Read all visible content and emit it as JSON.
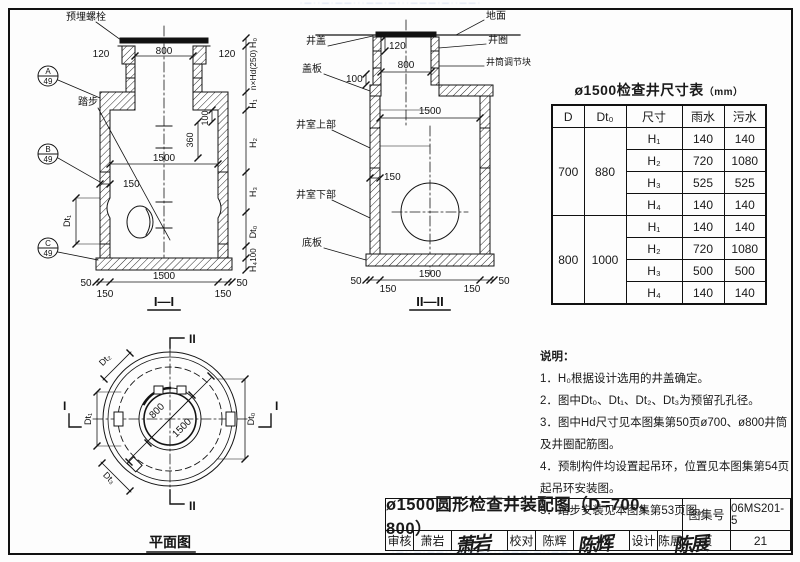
{
  "page": {
    "paper": "#fdfdfd",
    "line": "#1a1a1a",
    "watermark_color": "#7b97cf",
    "watermark_text": "·—··—·——···——·—···———·—··——·"
  },
  "s1": {
    "caption": "I—I",
    "bolt_label": "预埋螺栓",
    "step_label": "踏步",
    "d120": "120",
    "d800": "800",
    "d360": "360",
    "d100": "100",
    "d150": "150",
    "d1500": "1500",
    "d50": "50",
    "h0": "H₀",
    "nhd": "n×Hd(250)",
    "h1": "H₁",
    "h2": "H₂",
    "h3": "H₃",
    "h4": "H₄",
    "dt0": "Dt₀",
    "dt1": "Dt₁",
    "ca": "A",
    "cb": "B",
    "cc": "C",
    "cnum": "49"
  },
  "s2": {
    "caption": "II—II",
    "ground": "地面",
    "cover": "井盖",
    "ring": "井圈",
    "adjuster": "井筒调节块",
    "slab": "盖板",
    "upper": "井室上部",
    "lower": "井室下部",
    "base": "底板",
    "d120": "120",
    "d800": "800",
    "d100": "100",
    "d1500": "1500",
    "d150": "150",
    "d50": "50"
  },
  "plan": {
    "caption": "平面图",
    "d800": "800",
    "d1500": "1500",
    "dt0": "Dt₀",
    "dt1": "Dt₁",
    "dt2": "Dt₂",
    "dt3": "Dt₃",
    "mark_i": "I",
    "mark_ii": "II"
  },
  "table": {
    "title": "ø1500检查井尺寸表",
    "unit": "（mm）",
    "h_d": "D",
    "h_dto": "Dt₀",
    "h_size": "尺寸",
    "h_rain": "雨水",
    "h_sewage": "污水",
    "g1": {
      "d": "700",
      "dto": "880",
      "rows": [
        [
          "H₁",
          "140",
          "140"
        ],
        [
          "H₂",
          "720",
          "1080"
        ],
        [
          "H₃",
          "525",
          "525"
        ],
        [
          "H₄",
          "140",
          "140"
        ]
      ]
    },
    "g2": {
      "d": "800",
      "dto": "1000",
      "rows": [
        [
          "H₁",
          "140",
          "140"
        ],
        [
          "H₂",
          "720",
          "1080"
        ],
        [
          "H₃",
          "500",
          "500"
        ],
        [
          "H₄",
          "140",
          "140"
        ]
      ]
    }
  },
  "notes": {
    "title": "说明：",
    "n1": "1．H₀根据设计选用的井盖确定。",
    "n2": "2．图中Dt₀、Dt₁、Dt₂、Dt₃为预留孔孔径。",
    "n3": "3．图中Hd尺寸见本图集第50页ø700、ø800井筒及井圈配筋图。",
    "n4": "4．预制构件均设置起吊环，位置见本图集第54页起吊环安装图。",
    "n5": "5．踏步安装见本图集第53页图。"
  },
  "titleblock": {
    "title": "ø1500圆形检查井装配图（D=700、800）",
    "atlas_label": "图集号",
    "atlas_no": "06MS201-5",
    "page_label": "页",
    "page_no": "21",
    "check_label": "审核",
    "check_name": "萧岩",
    "check_sign": "萧岩",
    "proof_label": "校对",
    "proof_name": "陈辉",
    "proof_sign": "陈辉",
    "design_label": "设计",
    "design_name": "陈展",
    "design_sign": "陈展"
  }
}
